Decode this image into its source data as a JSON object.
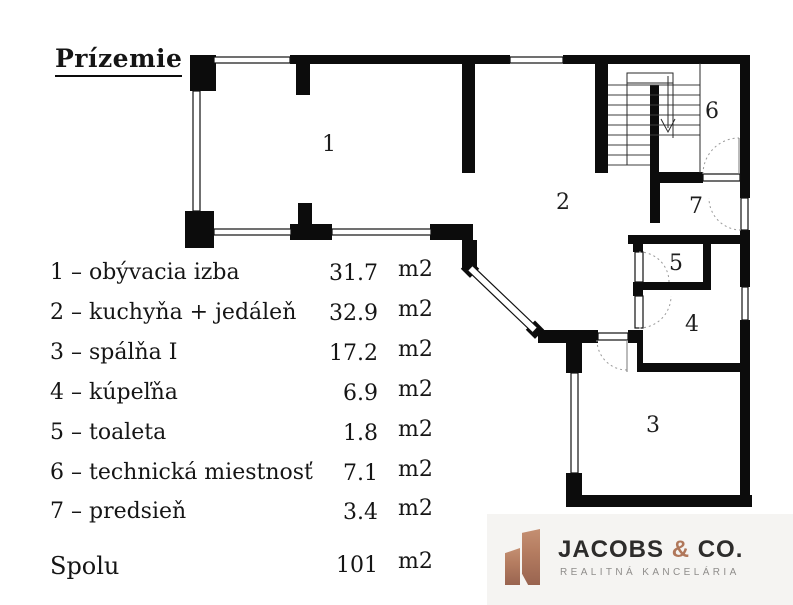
{
  "title": "Prízemie",
  "legend": {
    "rows": [
      {
        "label": "1 – obývacia izba",
        "value": "31.7",
        "unit": "m2"
      },
      {
        "label": "2 – kuchyňa + jedáleň",
        "value": "32.9",
        "unit": "m2"
      },
      {
        "label": "3 – spálňa I",
        "value": "17.2",
        "unit": "m2"
      },
      {
        "label": "4 – kúpeľňa",
        "value": "6.9",
        "unit": "m2"
      },
      {
        "label": "5 – toaleta",
        "value": "1.8",
        "unit": "m2"
      },
      {
        "label": "6 – technická miestnosť",
        "value": "7.1",
        "unit": "m2"
      },
      {
        "label": "7 – predsieň",
        "value": "3.4",
        "unit": "m2"
      }
    ],
    "total": {
      "label": "Spolu",
      "value": "101",
      "unit": "m2"
    }
  },
  "floorplan": {
    "rooms": [
      {
        "number": "1"
      },
      {
        "number": "2"
      },
      {
        "number": "3"
      },
      {
        "number": "4"
      },
      {
        "number": "5"
      },
      {
        "number": "6"
      },
      {
        "number": "7"
      }
    ]
  },
  "logo": {
    "name_left": "JACOBS ",
    "amp": "&",
    "name_right": " CO.",
    "subtitle": "REALITNÁ KANCELÁRIA",
    "colors": {
      "copper": "#b0775a",
      "dark": "#2d2c2b",
      "grey": "#8f8d8b"
    }
  }
}
